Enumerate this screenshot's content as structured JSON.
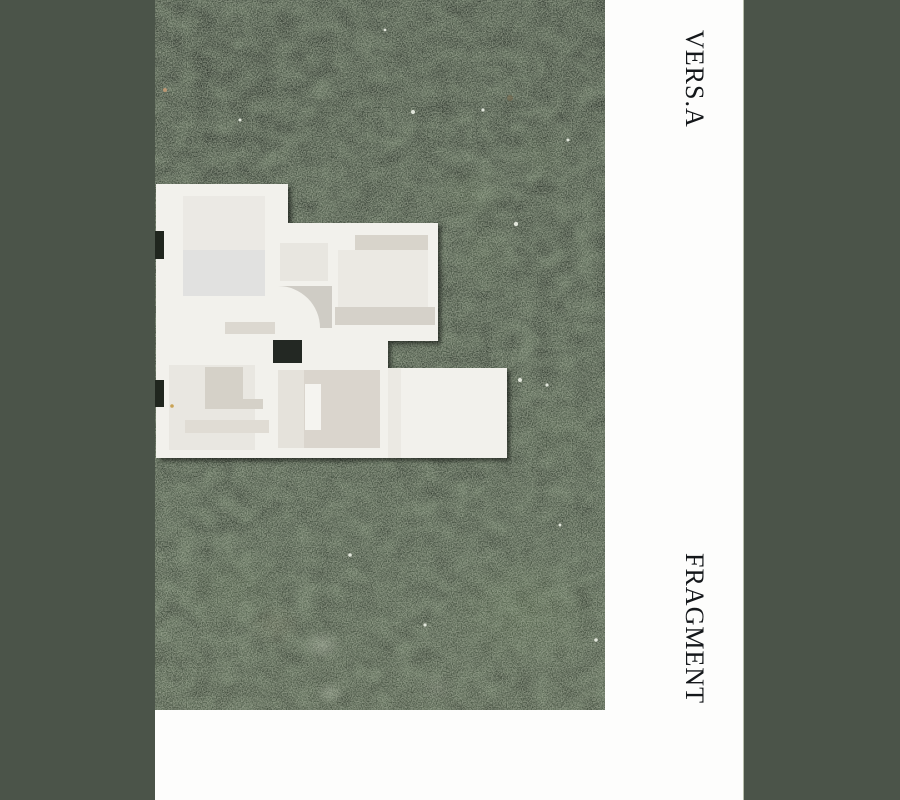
{
  "canvas": {
    "width": 900,
    "height": 800
  },
  "cover": {
    "masthead": "VERS.A",
    "title": "FRAGMENT",
    "photo_alt": "Top view of a white architectural scale model placed on dark mossy stone ground"
  },
  "colors": {
    "frame_green": "#4b5449",
    "page_white": "#fdfdfc",
    "photo_dark_base": "#20261e",
    "moss_green": "#546a42",
    "stone_gray": "#9a9c90",
    "model_white": "#f2f1ec",
    "model_shadow_beige": "#d5d1c8",
    "title_text": "#14171a"
  }
}
